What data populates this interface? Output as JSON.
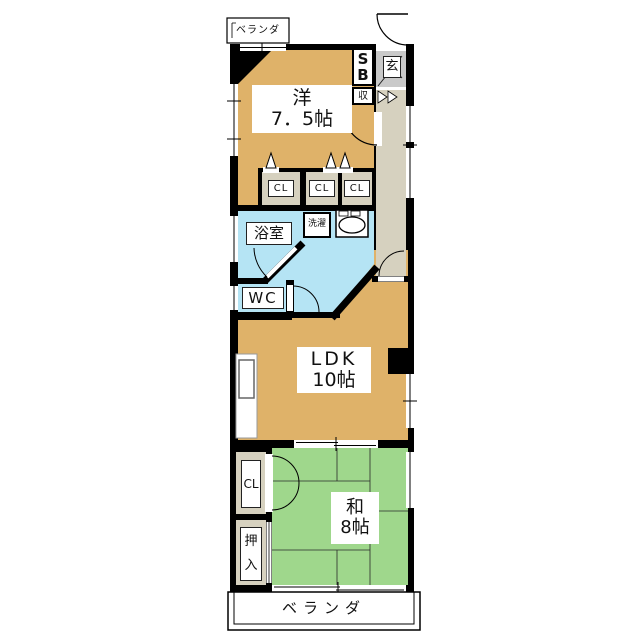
{
  "plan": {
    "veranda_top": "ベランダ",
    "veranda_bottom": "ベランダ",
    "entrance": "玄",
    "shoe_box": "SB",
    "storage": "収",
    "closets": [
      "CL",
      "CL",
      "CL"
    ],
    "closet_left": "CL",
    "oshiire": "押入",
    "bathroom": "浴室",
    "laundry": "洗濯",
    "wc": "WC",
    "western_room": {
      "name": "洋",
      "size": "7．5帖"
    },
    "ldk": {
      "name": "LDK",
      "size": "10帖"
    },
    "japanese_room": {
      "name": "和",
      "size": "8帖"
    }
  },
  "colors": {
    "wall": "#000000",
    "western_floor": "#DFB269",
    "ldk_floor": "#DFB269",
    "japanese_floor": "#9FD78C",
    "wet_area_floor": "#B5E4F4",
    "hallway_floor": "#D6D1BF",
    "closet_floor": "#D6D1BF",
    "entrance_tile": "#C9C9C9",
    "background": "#FFFFFF"
  }
}
